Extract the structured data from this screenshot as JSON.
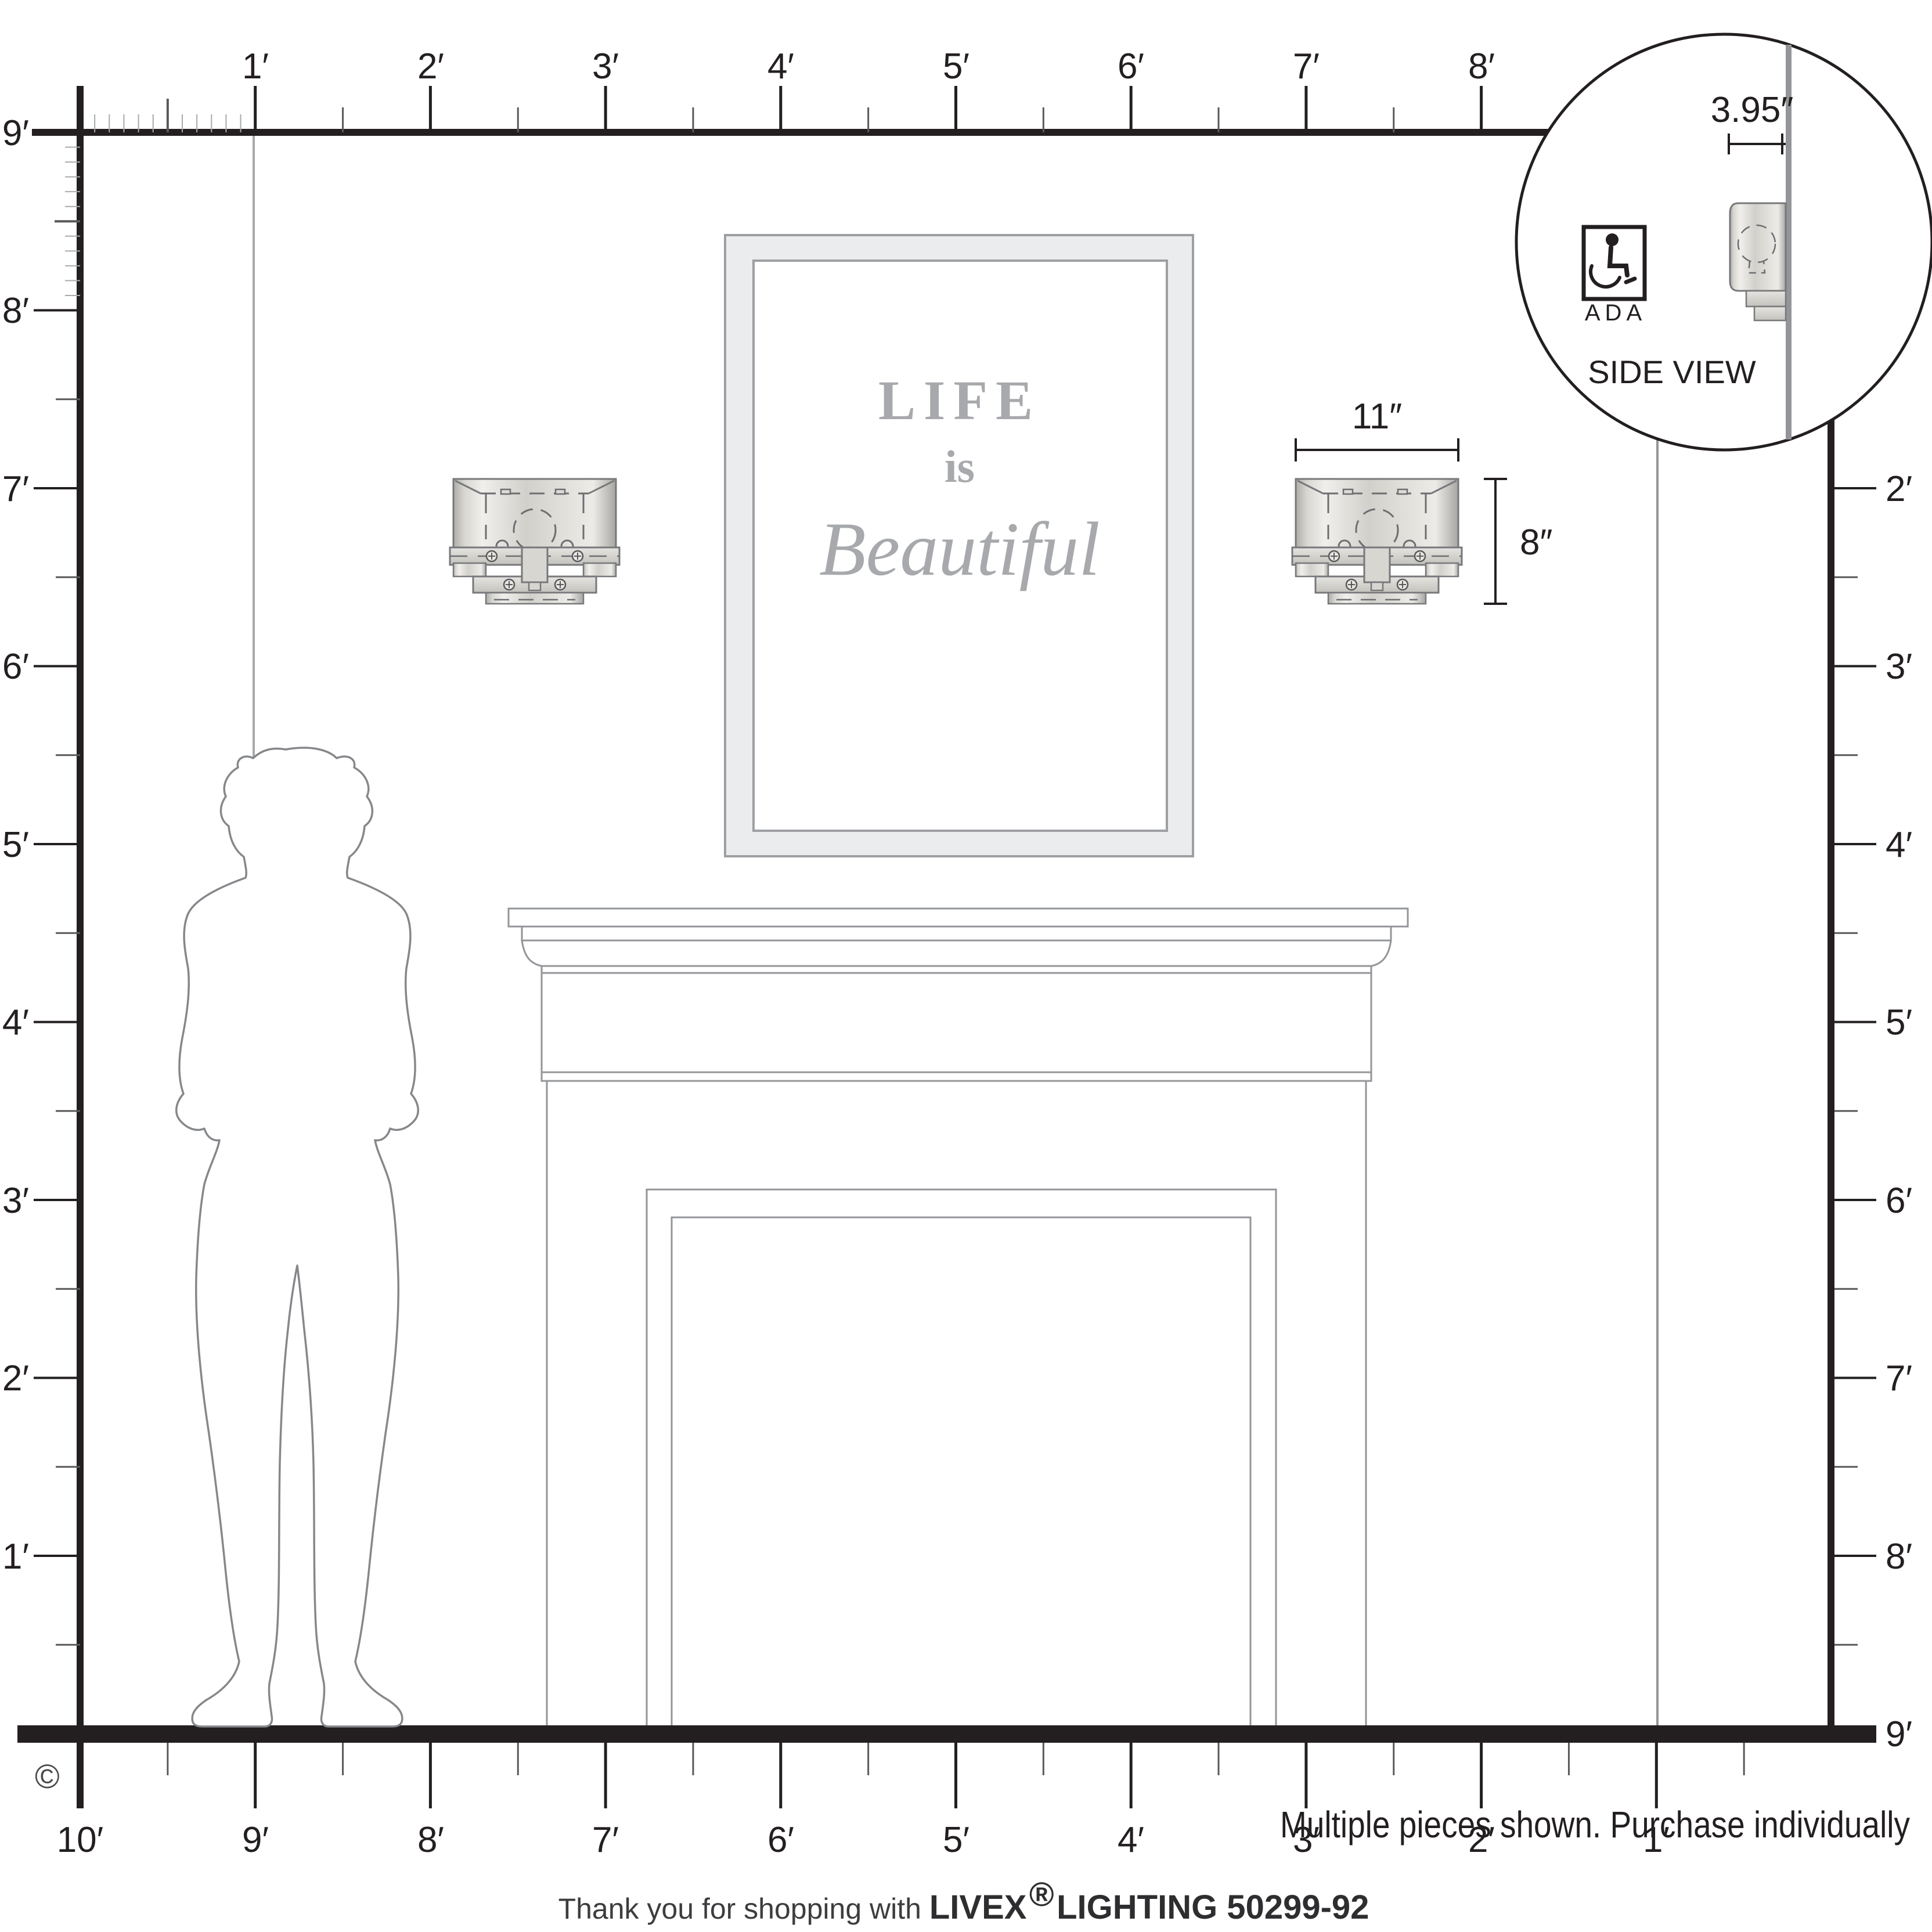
{
  "rulers": {
    "top": {
      "labels": [
        "1′",
        "2′",
        "3′",
        "4′",
        "5′",
        "6′",
        "7′",
        "8′"
      ]
    },
    "left": {
      "labels": [
        "9′",
        "8′",
        "7′",
        "6′",
        "5′",
        "4′",
        "3′",
        "2′",
        "1′"
      ]
    },
    "right": {
      "labels": [
        "2′",
        "3′",
        "4′",
        "5′",
        "6′",
        "7′",
        "8′",
        "9′"
      ]
    },
    "bottom": {
      "labels": [
        "10′",
        "9′",
        "8′",
        "7′",
        "6′",
        "5′",
        "4′",
        "3′",
        "2′",
        "1′"
      ]
    }
  },
  "artwork": {
    "line1": "LIFE",
    "line2": "is",
    "line3": "Beautiful"
  },
  "fixture_dims": {
    "width_label": "11″",
    "height_label": "8″"
  },
  "inset": {
    "depth_label": "3.95″",
    "ada_label": "ADA",
    "side_view_label": "SIDE VIEW"
  },
  "footer": {
    "note": "Multiple pieces shown. Purchase individually",
    "thanks_prefix": "Thank you for shopping with ",
    "brand": "LIVEX",
    "registered": "®",
    "brand_suffix": " LIGHTING 50299-92",
    "copyright": "©"
  },
  "colors": {
    "ink": "#231f20",
    "diagram_gray": "#939598",
    "light_gray_text": "#a7a9ac",
    "silhouette_gray": "#85878a",
    "nickel_light": "#f1efec",
    "nickel_dark": "#b0aeaa"
  }
}
